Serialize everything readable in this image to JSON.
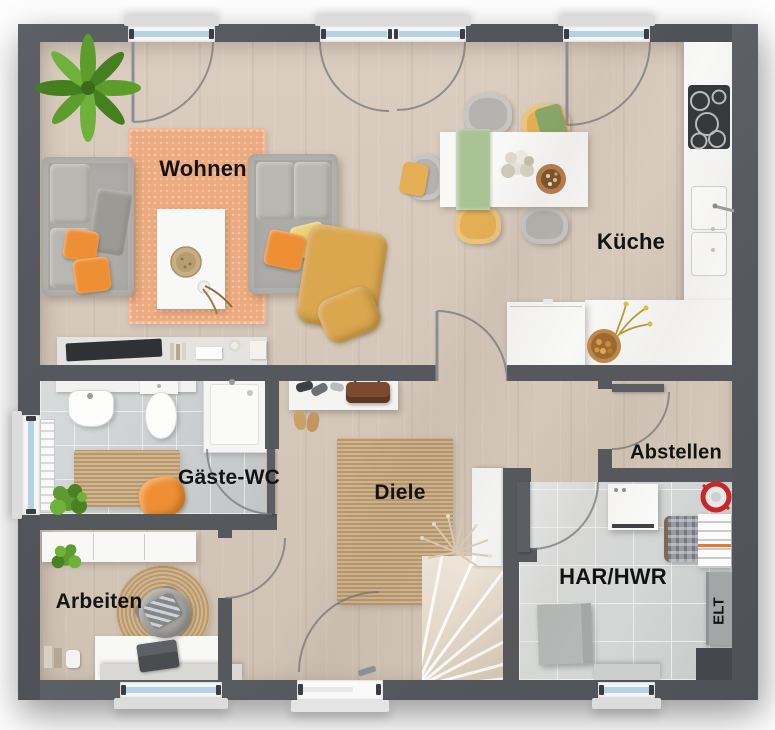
{
  "rooms": {
    "wohnen": {
      "label": "Wohnen"
    },
    "kueche": {
      "label": "Küche"
    },
    "gaeste_wc": {
      "label": "Gäste-WC"
    },
    "diele": {
      "label": "Diele"
    },
    "abstellen": {
      "label": "Abstellen"
    },
    "arbeiten": {
      "label": "Arbeiten"
    },
    "har_hwr": {
      "label": "HAR/HWR"
    },
    "elt": {
      "label": "ELT"
    }
  },
  "colors": {
    "wall": "#55585d",
    "wood_floor": "#d8cabb",
    "tile_wc": "#ccd0d0",
    "tile_har": "#d7d9d8",
    "rug_orange": "#edaa7f",
    "jute": "#c9a97c",
    "counter": "#f8f8f7",
    "sofa": "#adaba7",
    "mustard": "#daa64e",
    "accent_orange": "#ee8f35",
    "window_glass": "#b5d2e4",
    "plant_green": "#5f9c2e",
    "stairs_wood": "#e9dccb"
  }
}
